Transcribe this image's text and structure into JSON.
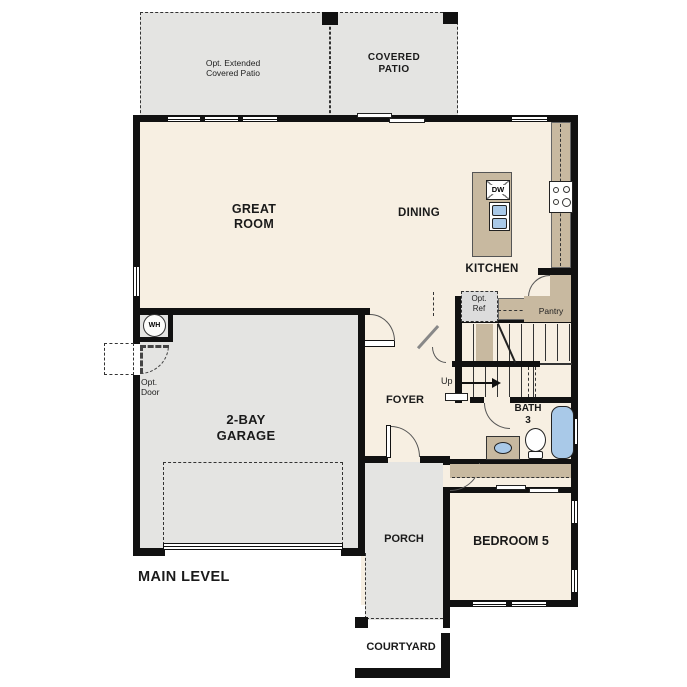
{
  "plan": {
    "title": "MAIN LEVEL",
    "rooms": {
      "great_room": {
        "line1": "GREAT",
        "line2": "ROOM"
      },
      "dining": {
        "label": "DINING"
      },
      "kitchen": {
        "label": "KITCHEN"
      },
      "pantry": {
        "label": "Pantry"
      },
      "foyer": {
        "label": "FOYER"
      },
      "garage": {
        "line1": "2-BAY",
        "line2": "GARAGE"
      },
      "bath3": {
        "line1": "BATH",
        "line2": "3"
      },
      "bedroom5": {
        "label": "BEDROOM 5"
      },
      "porch": {
        "label": "PORCH"
      },
      "courtyard": {
        "label": "COURTYARD"
      },
      "covered_patio": {
        "line1": "COVERED",
        "line2": "PATIO"
      },
      "opt_extended_patio": {
        "line1": "Opt. Extended",
        "line2": "Covered Patio"
      }
    },
    "annotations": {
      "up": "Up",
      "opt_ref": {
        "line1": "Opt.",
        "line2": "Ref"
      },
      "opt_door": {
        "line1": "Opt.",
        "line2": "Door"
      },
      "water_heater": "WH",
      "dishwasher": "DW"
    },
    "colors": {
      "floor": "#f7efe2",
      "hardscape": "#e4e4e2",
      "counter": "#c8b9a0",
      "fixture_blue": "#a9c9e8",
      "wall": "#111111"
    }
  }
}
